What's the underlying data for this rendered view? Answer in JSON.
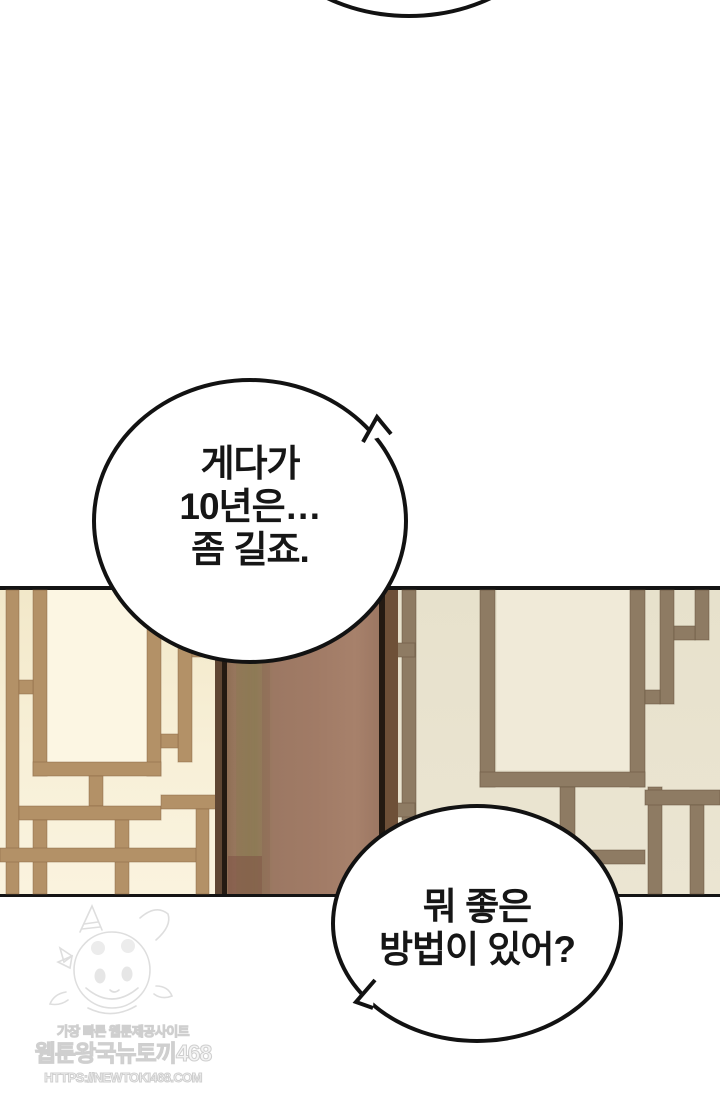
{
  "page": {
    "type": "webtoon-episode-panel",
    "background": "#ffffff"
  },
  "speech_bubbles": {
    "middle": {
      "lines": [
        "게다가",
        "10년은…",
        "좀 길죠."
      ]
    },
    "bottom": {
      "lines": [
        "뭐 좋은",
        "방법이 있어?"
      ]
    }
  },
  "scene": {
    "description": "traditional-korean-lattice-doors-with-wood-pillar",
    "palette": {
      "left_door_paper": "#f7efd5",
      "left_door_frame": "#b39167",
      "right_door_paper": "#e9e3cf",
      "right_door_frame": "#8e7b63",
      "pillar": "#9c7a64",
      "panel_outline": "#141414"
    }
  },
  "watermark": {
    "tagline": "가장 빠른 웹툰제공사이트",
    "site_name": "웹툰왕국뉴토끼468",
    "url": "HTTPS://NEWTOKI468.COM",
    "mascot": "bunny-hood-girl-sketch",
    "color": "#d4d4d4"
  }
}
